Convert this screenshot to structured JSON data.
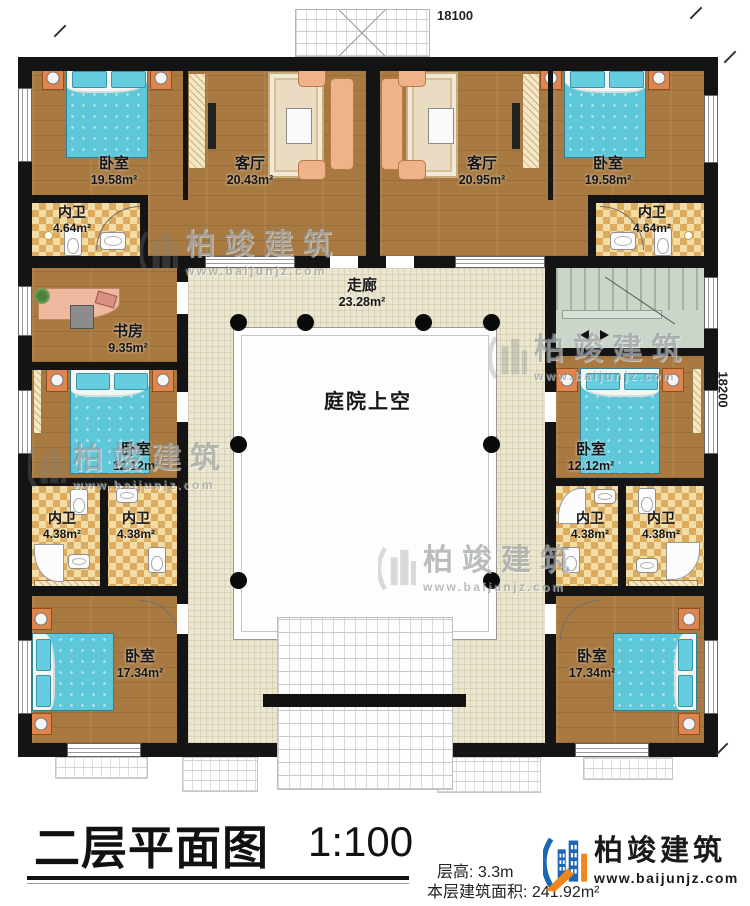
{
  "dimensions": {
    "top": "18100",
    "right": "18200"
  },
  "rooms": [
    {
      "id": "bedroom-top-left",
      "name": "卧室",
      "area": "19.58m²"
    },
    {
      "id": "living-left",
      "name": "客厅",
      "area": "20.43m²"
    },
    {
      "id": "living-right",
      "name": "客厅",
      "area": "20.95m²"
    },
    {
      "id": "bedroom-top-right",
      "name": "卧室",
      "area": "19.58m²"
    },
    {
      "id": "bathroom-top-left",
      "name": "内卫",
      "area": "4.64m²"
    },
    {
      "id": "bathroom-top-right",
      "name": "内卫",
      "area": "4.64m²"
    },
    {
      "id": "study",
      "name": "书房",
      "area": "9.35m²"
    },
    {
      "id": "corridor",
      "name": "走廊",
      "area": "23.28m²"
    },
    {
      "id": "courtyard",
      "name": "庭院上空",
      "area": ""
    },
    {
      "id": "bedroom-mid-left",
      "name": "卧室",
      "area": "12.12m²"
    },
    {
      "id": "bedroom-mid-right",
      "name": "卧室",
      "area": "12.12m²"
    },
    {
      "id": "bathroom-mid-left-1",
      "name": "内卫",
      "area": "4.38m²"
    },
    {
      "id": "bathroom-mid-left-2",
      "name": "内卫",
      "area": "4.38m²"
    },
    {
      "id": "bathroom-mid-right-1",
      "name": "内卫",
      "area": "4.38m²"
    },
    {
      "id": "bathroom-mid-right-2",
      "name": "内卫",
      "area": "4.38m²"
    },
    {
      "id": "bedroom-bottom-left",
      "name": "卧室",
      "area": "17.34m²"
    },
    {
      "id": "bedroom-bottom-right",
      "name": "卧室",
      "area": "17.34m²"
    }
  ],
  "title_block": {
    "title": "二层平面图",
    "scale": "1:100",
    "floor_height": "层高: 3.3m",
    "floor_area": "本层建筑面积: 241.92m²"
  },
  "logo": {
    "name": "柏竣建筑",
    "website": "www.baijunjz.com"
  },
  "watermark": {
    "brand": "柏竣建筑",
    "website": "www.baijunjz.com"
  },
  "colors": {
    "wall": "#141414",
    "wood_floor": "#a87a42",
    "corridor_tile": "#ebe6cf",
    "bath_checker": "#dcab5e",
    "stair": "#cbd6ca",
    "bed": "#5ec7da",
    "logo_blue": "#1b66b5",
    "logo_orange": "#f08519"
  }
}
